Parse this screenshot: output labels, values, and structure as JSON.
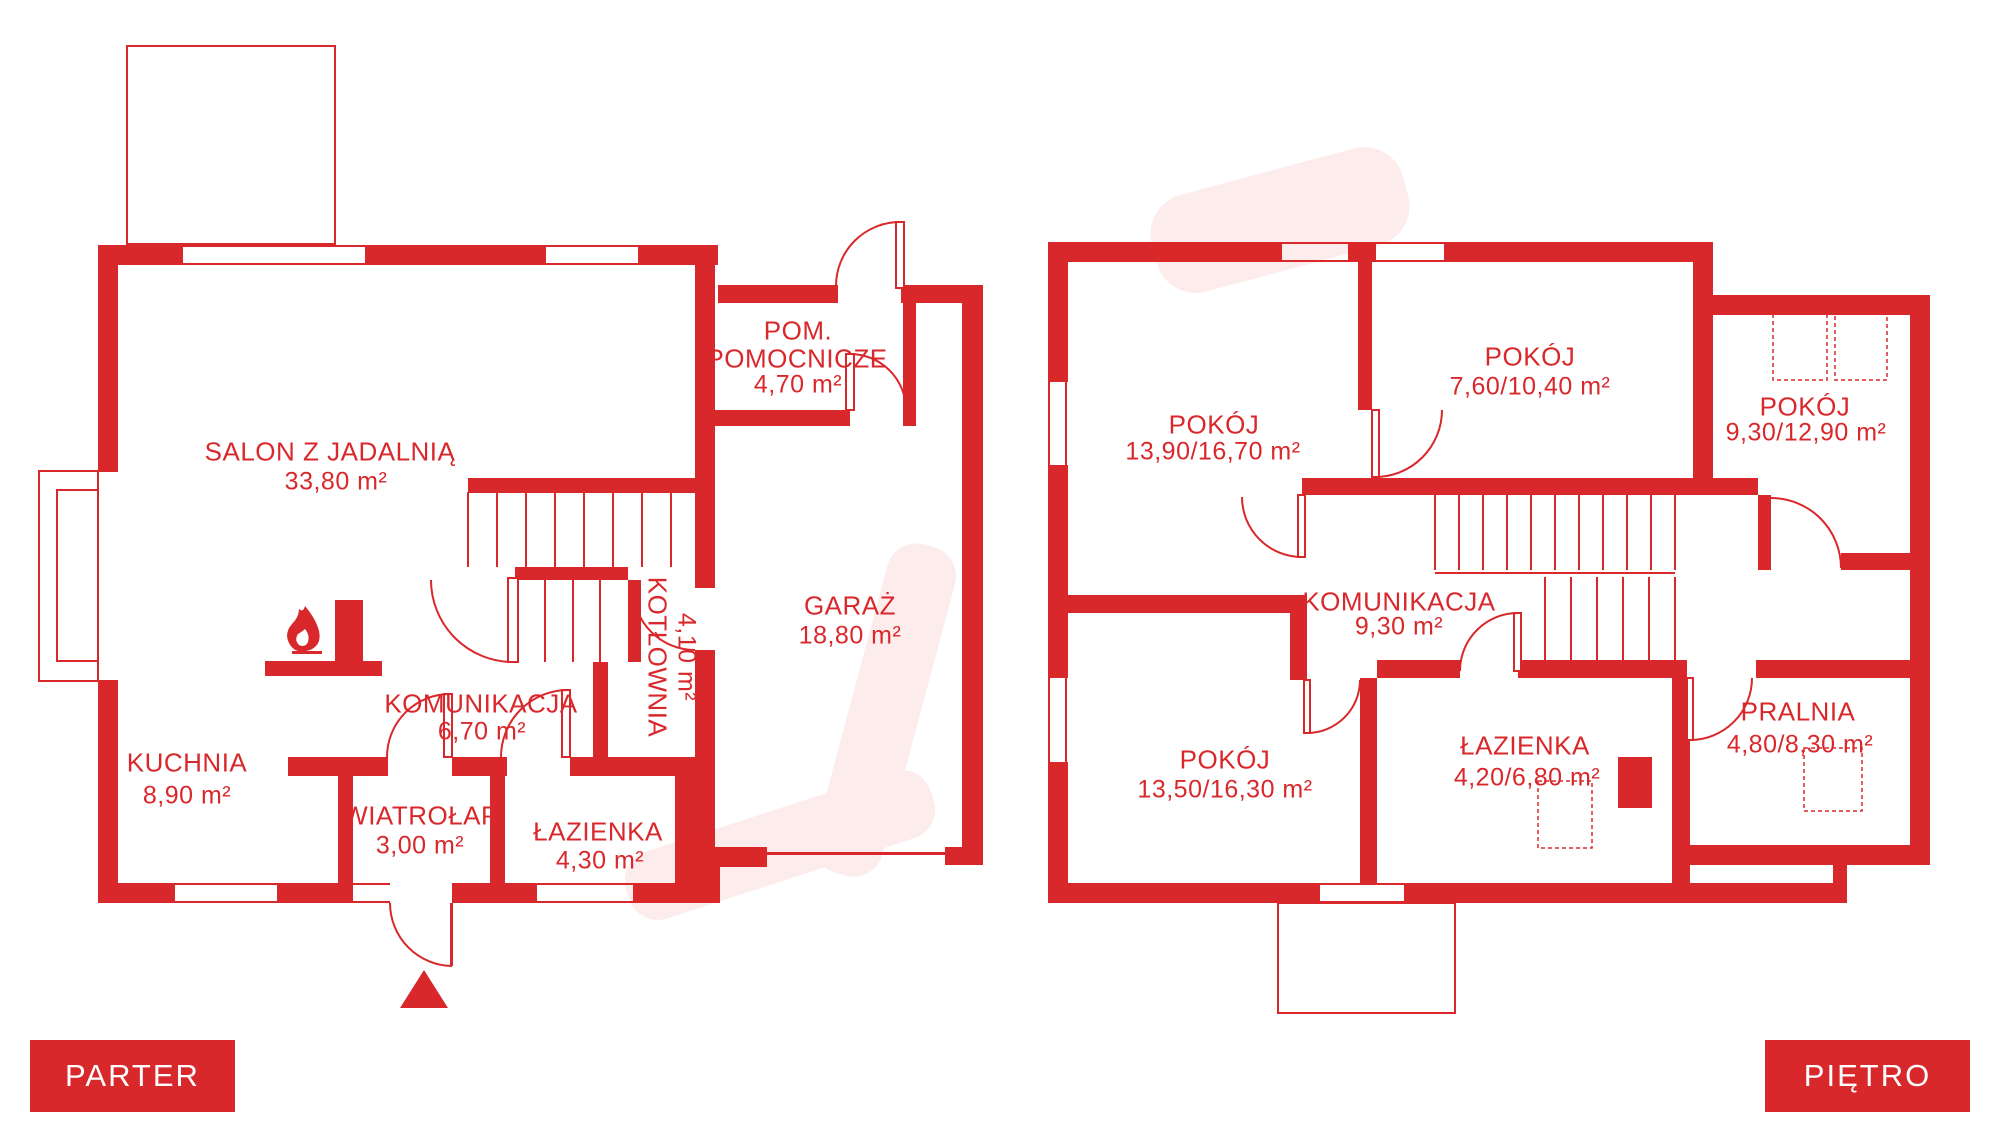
{
  "colors": {
    "accent": "#d9282b",
    "background": "#ffffff"
  },
  "icons": {
    "fireplace": "flame-icon",
    "entrance_marker": "triangle-up-icon"
  },
  "parter": {
    "badge": "PARTER",
    "rooms": {
      "salon": {
        "name": "SALON Z JADALNIĄ",
        "area": "33,80 m²"
      },
      "pom": {
        "name": "POM.",
        "name2": "POMOCNICZE",
        "area": "4,70 m²"
      },
      "garaz": {
        "name": "GARAŻ",
        "area": "18,80 m²"
      },
      "kotlownia": {
        "name": "KOTŁOWNIA",
        "area": "4,10 m²"
      },
      "komunikacja": {
        "name": "KOMUNIKACJA",
        "area": "6,70 m²"
      },
      "kuchnia": {
        "name": "KUCHNIA",
        "area": "8,90 m²"
      },
      "wiatrolap": {
        "name": "WIATROŁAP",
        "area": "3,00 m²"
      },
      "lazienka": {
        "name": "ŁAZIENKA",
        "area": "4,30 m²"
      }
    }
  },
  "pietro": {
    "badge": "PIĘTRO",
    "rooms": {
      "pokoj_nw": {
        "name": "POKÓJ",
        "area": "13,90/16,70 m²"
      },
      "pokoj_n": {
        "name": "POKÓJ",
        "area": "7,60/10,40 m²"
      },
      "pokoj_ne": {
        "name": "POKÓJ",
        "area": "9,30/12,90 m²"
      },
      "komunikacja": {
        "name": "KOMUNIKACJA",
        "area": "9,30 m²"
      },
      "pokoj_sw": {
        "name": "POKÓJ",
        "area": "13,50/16,30 m²"
      },
      "lazienka": {
        "name": "ŁAZIENKA",
        "area": "4,20/6,80 m²"
      },
      "pralnia": {
        "name": "PRALNIA",
        "area": "4,80/8,30 m²"
      }
    }
  }
}
